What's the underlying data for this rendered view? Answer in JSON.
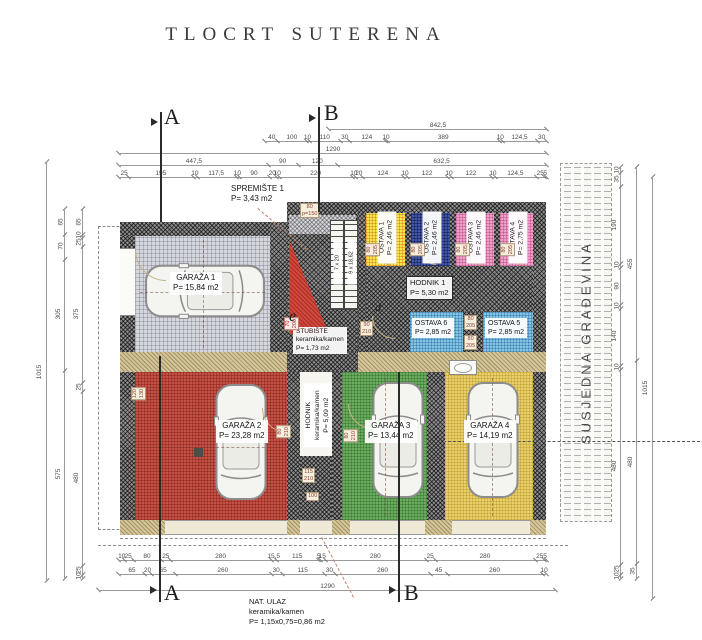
{
  "title": "TLOCRT  SUTERENA",
  "section_markers": {
    "a": "A",
    "b": "B"
  },
  "rooms": {
    "garaza1": {
      "name": "GARAŽA 1",
      "area": "P= 15,84 m2"
    },
    "garaza2": {
      "name": "GARAŽA 2",
      "area": "P= 23,28 m2"
    },
    "garaza3": {
      "name": "GARAŽA 3",
      "area": "P= 13,44 m2"
    },
    "garaza4": {
      "name": "GARAŽA 4",
      "area": "P= 14,19 m2"
    },
    "spremiste1": {
      "name": "SPREMIŠTE 1",
      "area": "P= 3,43 m2"
    },
    "ostava1": {
      "name": "OSTAVA 1",
      "area": "P= 2,46 m2"
    },
    "ostava2": {
      "name": "OSTAVA 2",
      "area": "P= 2,46 m2"
    },
    "ostava3": {
      "name": "OSTAVA 3",
      "area": "P= 2,46 m2"
    },
    "ostava4": {
      "name": "OSTAVA 4",
      "area": "P= 2,75 m2"
    },
    "ostava5": {
      "name": "OSTAVA 5",
      "area": "P= 2,85 m2"
    },
    "ostava6": {
      "name": "OSTAVA 6",
      "area": "P= 2,85 m2"
    },
    "hodnik1": {
      "name": "HODNIK 1",
      "area": "P= 5,30 m2"
    },
    "hodnik": {
      "name": "HODNIK",
      "material": "keramika/kamen",
      "area": "P= 5,09 m2"
    },
    "stubiste": {
      "name": "STUBIŠTE",
      "material": "keramika/kamen",
      "area": "P= 1,73 m2"
    },
    "nat_ulaz": {
      "name": "NAT. ULAZ",
      "material": "keramika/kamen",
      "area": "P= 1,15x0,75=0,86 m2"
    },
    "susjedna_gradevina": {
      "name": "SUSJEDNA GRAĐEVINA"
    }
  },
  "stairs": {
    "flight1": "7 x 20",
    "flight2": "9 x 18,62"
  },
  "markers": {
    "e": "e",
    "d": "d"
  },
  "tags": {
    "ostava_door": "80|205",
    "stub_door": "90|210",
    "stair_door": "70|200",
    "stair_window": "80|p=150",
    "garaza2_window": "120|130",
    "garaza2_door": "80|210",
    "garaza3_door": "80|210",
    "ulaz_door": "115|210",
    "ulaz_width": "100"
  },
  "dims": {
    "top_total_right": [
      "842,5"
    ],
    "top_row1": [
      "40",
      "100",
      "10",
      "110",
      "30",
      "124",
      "10",
      "389",
      "10",
      "124,5",
      "30"
    ],
    "top_total": [
      "1290"
    ],
    "top_row3": [
      "447,5",
      "90",
      "120",
      "632,5"
    ],
    "top_row4": [
      "25",
      "195",
      "10",
      "117,5",
      "10",
      "90",
      "20",
      "10",
      "220",
      "10",
      "20",
      "124",
      "10",
      "122",
      "10",
      "122",
      "10",
      "124,5",
      "25",
      "5"
    ],
    "left_total": [
      "1015"
    ],
    "left_outer": [
      "65",
      "70",
      "305",
      "575"
    ],
    "left_inner": [
      "65",
      "10",
      "25",
      "375",
      "25",
      "480",
      "25",
      "10"
    ],
    "right_inner": [
      "10",
      "35",
      "190",
      "10",
      "90",
      "10",
      "140",
      "10",
      "480",
      "25",
      "10"
    ],
    "right_mid": [
      "455",
      "480",
      "35"
    ],
    "right_total": [
      "1015"
    ],
    "bottom_row1": [
      "10",
      "25",
      "80",
      "25",
      "280",
      "15,5",
      "115",
      "5",
      "15",
      "280",
      "25",
      "280",
      "25",
      "5"
    ],
    "bottom_row2": [
      "65",
      "20",
      "65",
      "260",
      "30",
      "115",
      "30",
      "260",
      "45",
      "260",
      "10"
    ],
    "bottom_total": [
      "1290"
    ]
  }
}
